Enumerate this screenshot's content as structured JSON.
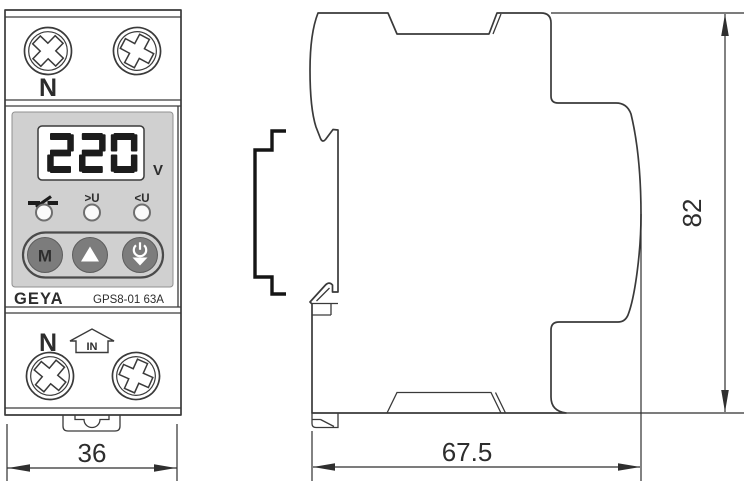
{
  "colors": {
    "line": "#3a3a3a",
    "panel_gray": "#d0d0d0",
    "button_gray": "#7c7c7c",
    "lcd_segment": "#1c1c1c"
  },
  "front_view": {
    "top_terminal_label": "N",
    "display": {
      "value": "220",
      "unit": "V"
    },
    "indicators": {
      "contact_icon": "relay-contact-icon",
      "over_voltage_label": ">U",
      "under_voltage_label": "<U"
    },
    "buttons": {
      "mode_label": "M",
      "up_icon": "up-arrow-icon",
      "power_icon": "power-down-icon"
    },
    "brand": "GEYA",
    "model": "GPS8-01 63A",
    "bottom_labels": {
      "neutral": "N",
      "input": "IN"
    },
    "dimension_width_mm": "36"
  },
  "side_view": {
    "din_rail_icon": "din-rail-profile-icon",
    "dimension_height_mm": "82",
    "dimension_depth_mm": "67.5"
  }
}
